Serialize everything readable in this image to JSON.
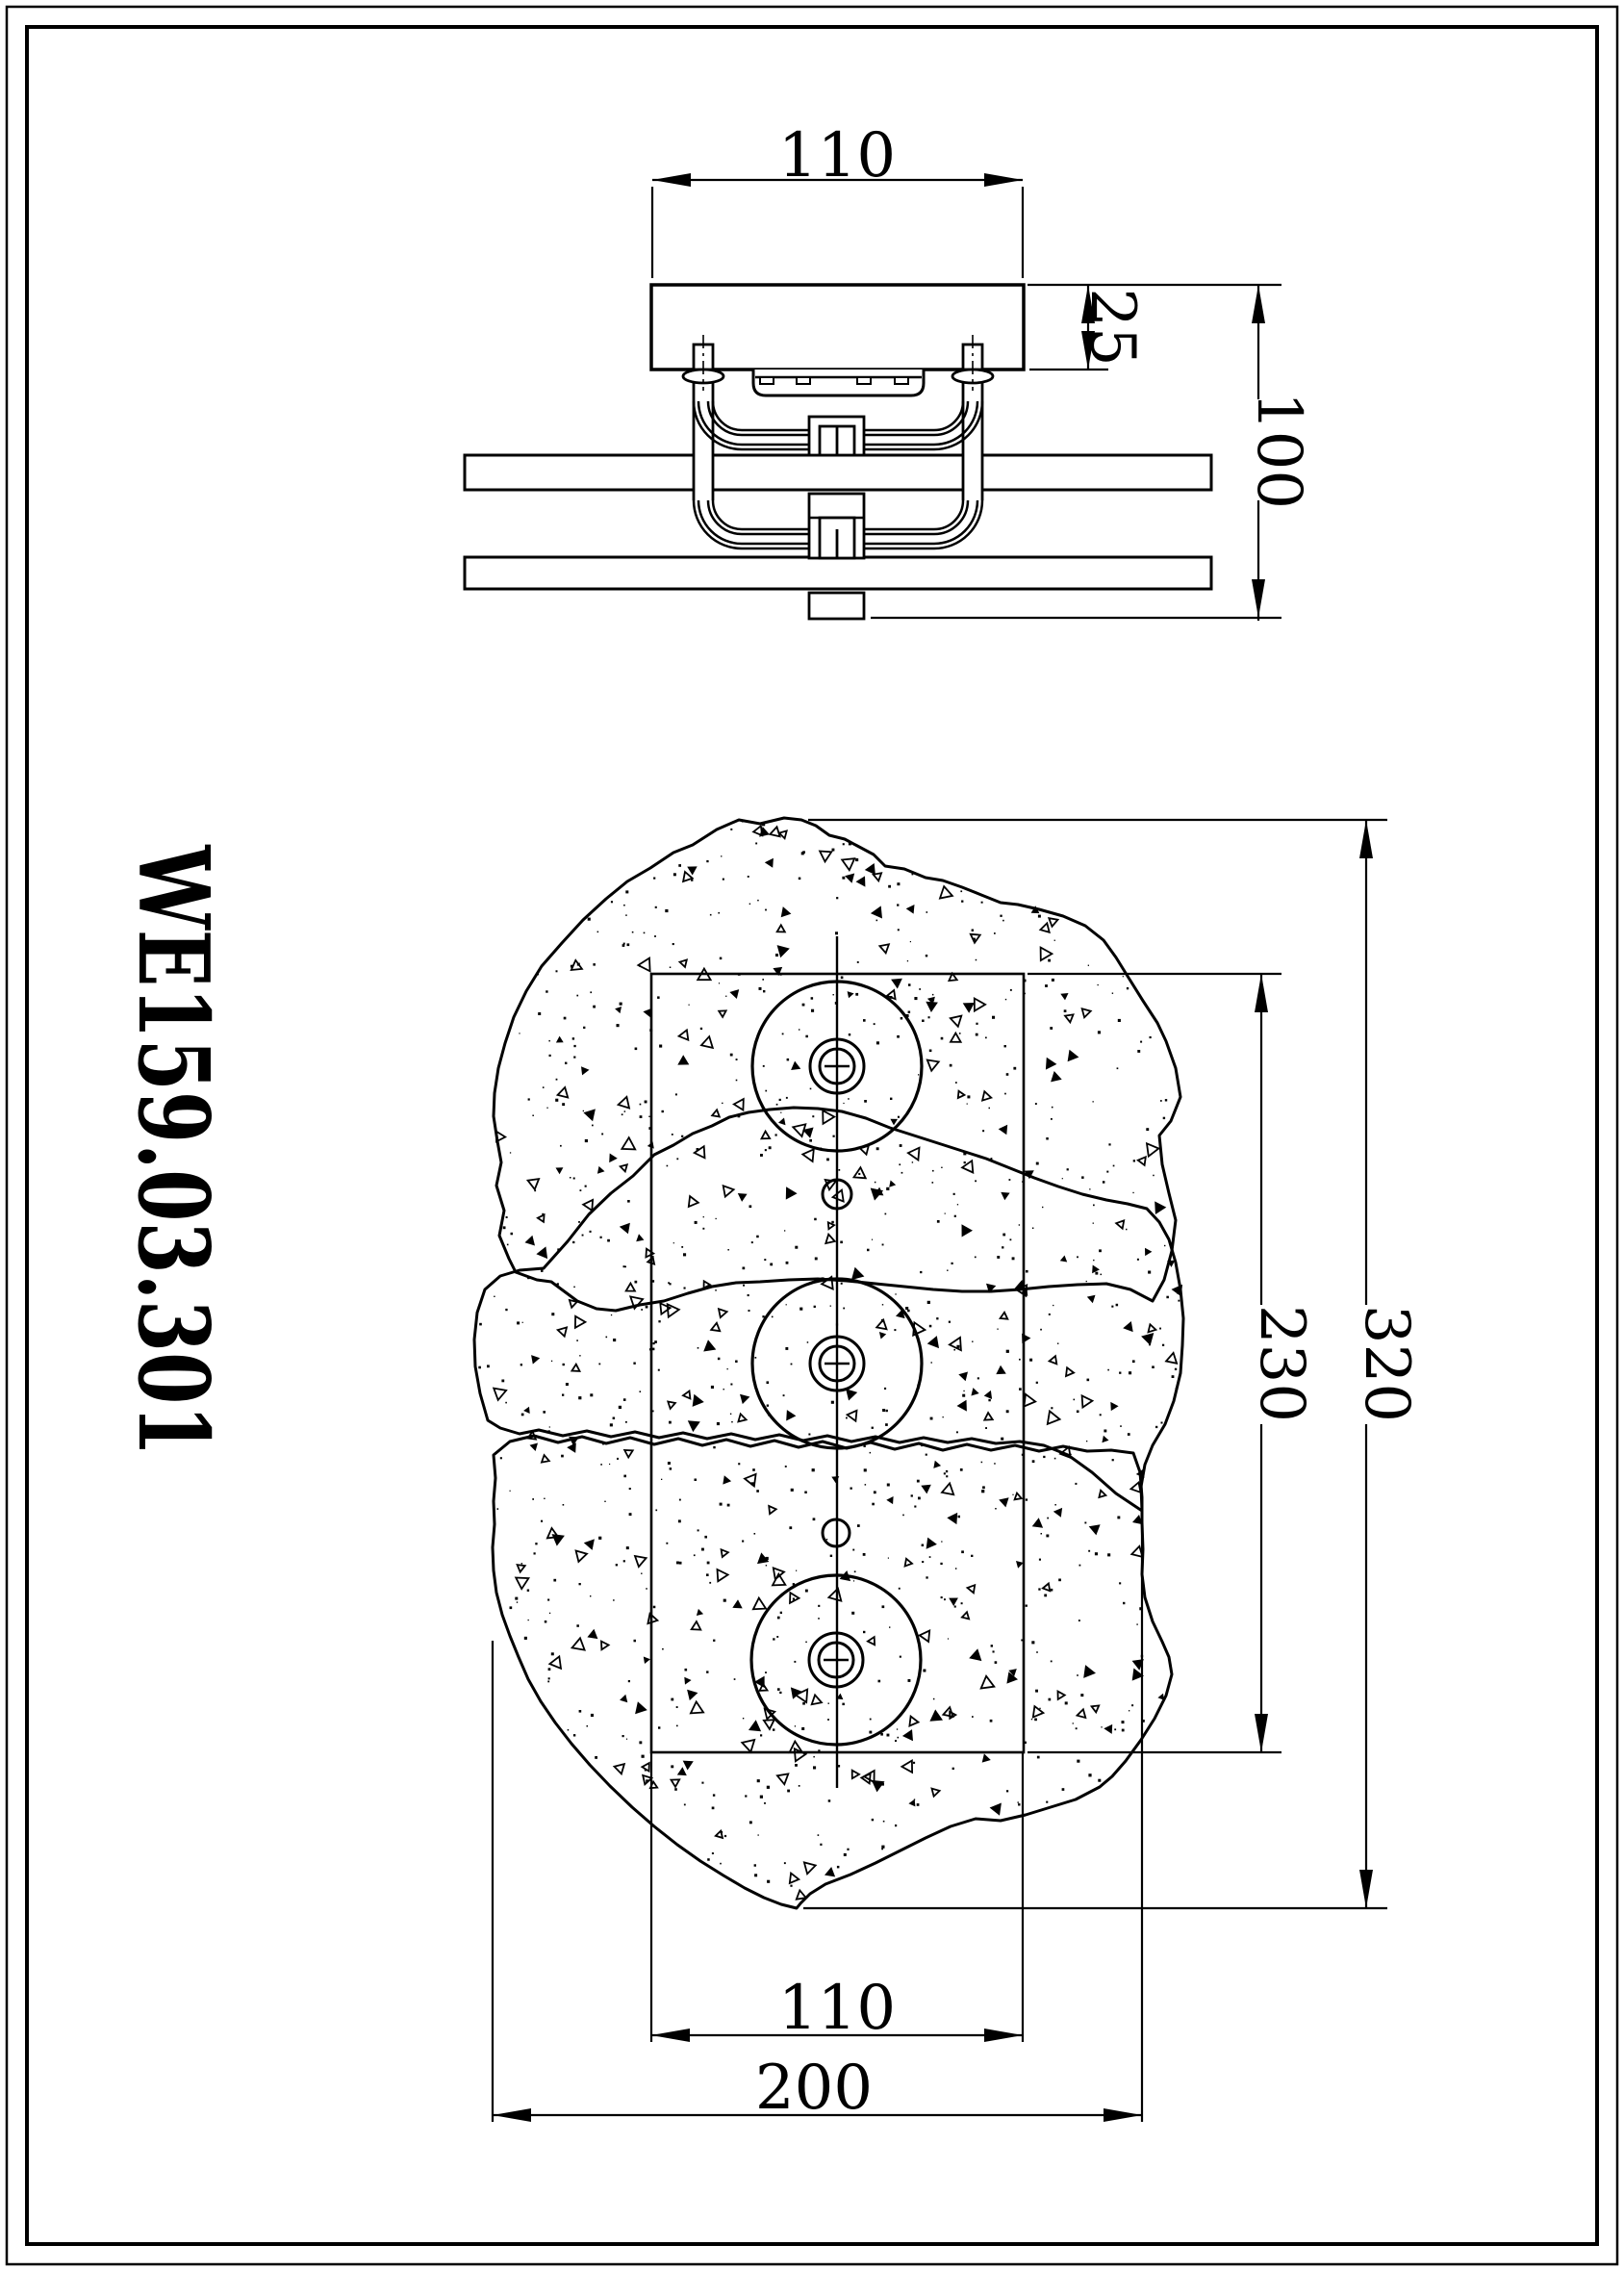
{
  "page": {
    "background": "#ffffff",
    "line_color": "#000000"
  },
  "title_block": {
    "part_number": "WE159.03.301"
  },
  "side_view": {
    "dim_canopy_width": "110",
    "dim_canopy_height": "25",
    "dim_overall_height": "100"
  },
  "plan_view": {
    "dim_mount_width": "110",
    "dim_mount_height": "230",
    "dim_overall_length": "320",
    "dim_overall_width": "200"
  }
}
